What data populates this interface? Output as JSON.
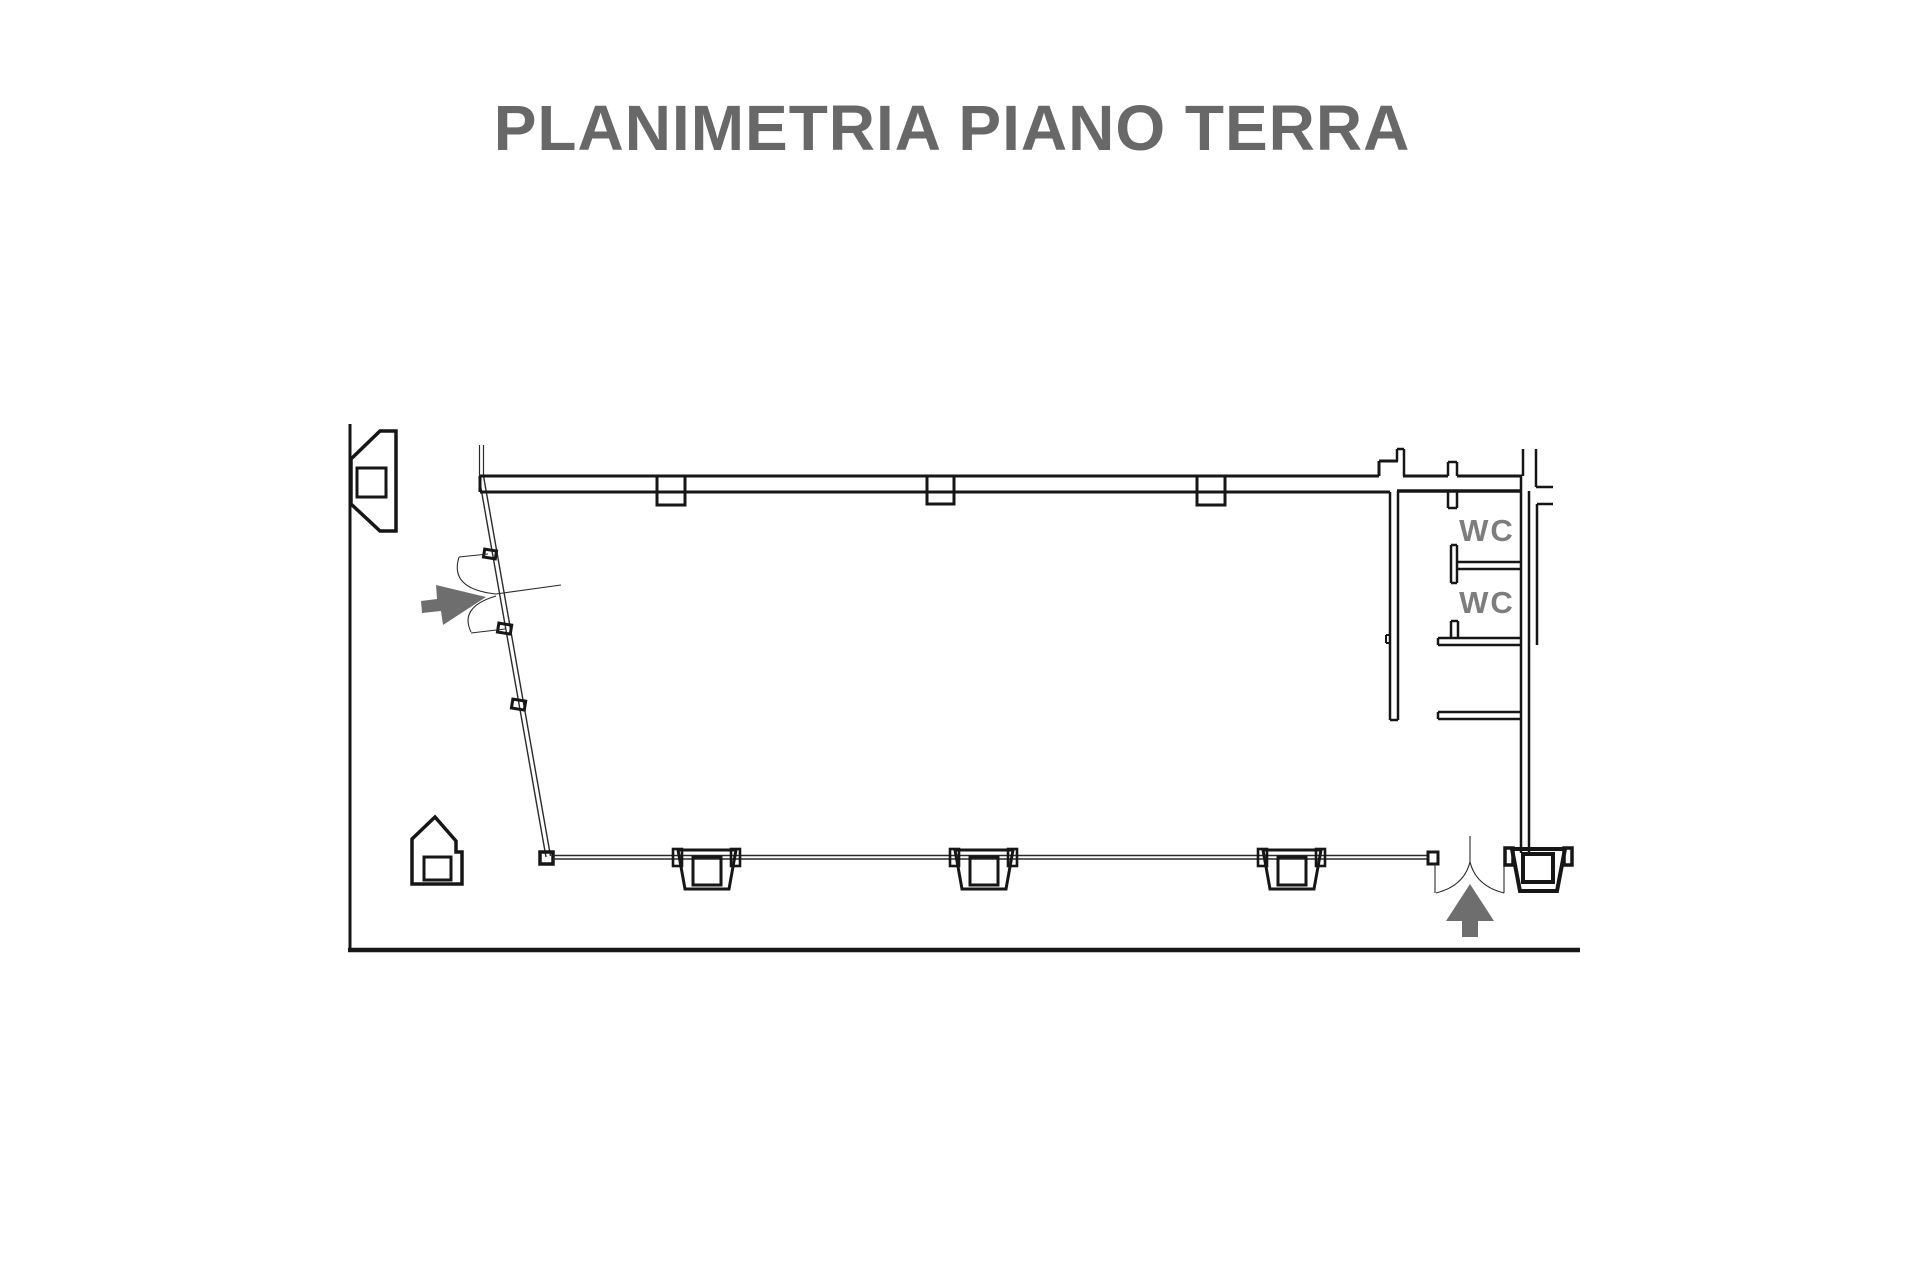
{
  "title": "PLANIMETRIA PIANO TERRA",
  "floor_plan": {
    "labels": {
      "wc_1": "WC",
      "wc_2": "WC"
    },
    "icons": {
      "entrance_arrow_left": "gray arrow pointing right at left entrance door",
      "entrance_arrow_bottom": "gray arrow pointing up at bottom entrance door"
    },
    "colors": {
      "background": "#ffffff",
      "wall_ink": "#161616",
      "thin_line": "#2a2a2a",
      "title_gray": "#686868",
      "label_gray": "#7d7d7d",
      "arrow_gray": "#6e6e6e"
    }
  }
}
